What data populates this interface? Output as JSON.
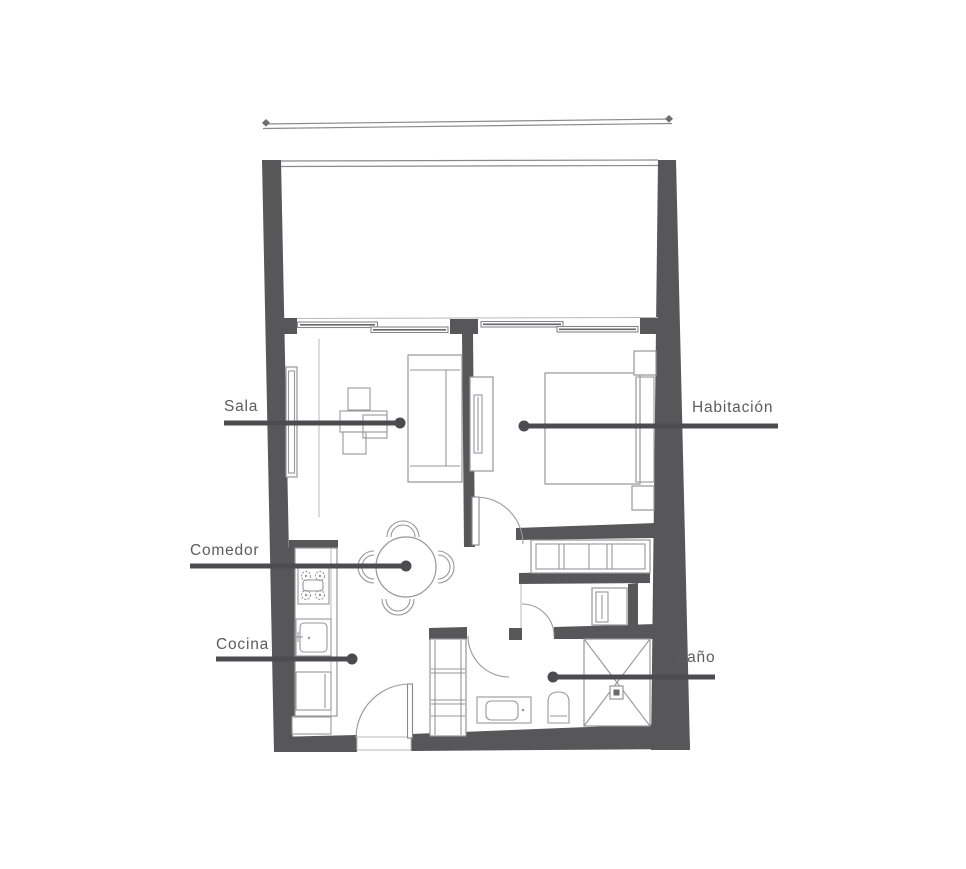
{
  "page": {
    "type": "architectural-floor-plan",
    "background": "#ffffff"
  },
  "labels": {
    "sala": "Sala",
    "habitacion": "Habitación",
    "comedor": "Comedor",
    "cocina": "Cocina",
    "bano": "Baño"
  },
  "colors": {
    "wall": "#57575a",
    "furniture_line": "#97979b",
    "light_line": "#b9b9bc",
    "leader_line": "#4c4c50",
    "label_text": "#5c5c60",
    "background": "#ffffff"
  }
}
